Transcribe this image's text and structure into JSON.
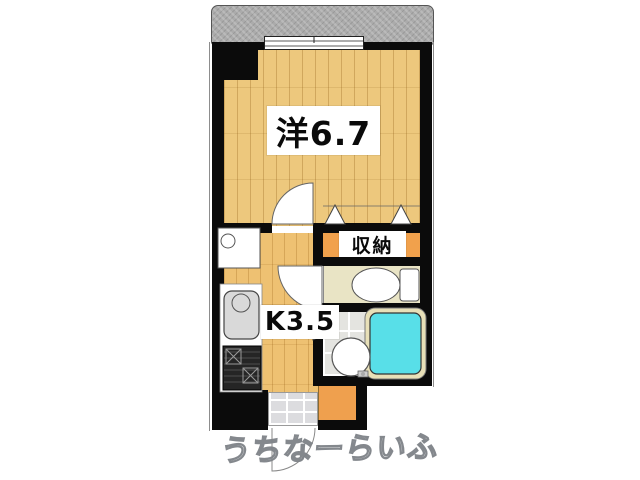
{
  "plan": {
    "title": "1K apartment floor plan",
    "rooms": [
      {
        "id": "western_room",
        "label": "洋6.7"
      },
      {
        "id": "storage",
        "label": "収納"
      },
      {
        "id": "kitchen",
        "label": "K3.5"
      }
    ],
    "watermark": "うちなーらいふ",
    "fixtures": [
      "balcony",
      "sliding-window",
      "washing-machine-pan",
      "kitchen-counter",
      "kitchen-sink",
      "gas-stove",
      "toilet",
      "washbasin",
      "bathtub",
      "room-door-arc",
      "toilet-door-arc",
      "entrance-door-arc",
      "closet-folding-door-markers",
      "bathroom-folding-door-marker",
      "entrance-tiles"
    ],
    "colors": {
      "wall": "#0b0b0b",
      "wood": "#edc87d",
      "kitchen_wood": "#eec172",
      "closet": "#f1a14c",
      "hall": "#efa04e",
      "toilet_floor": "#e9e4c5",
      "bath_floor": "#e4e4e0",
      "tub": "#58dfe8",
      "balcony": "#ababab",
      "genkan": "#dcdcdf"
    }
  }
}
